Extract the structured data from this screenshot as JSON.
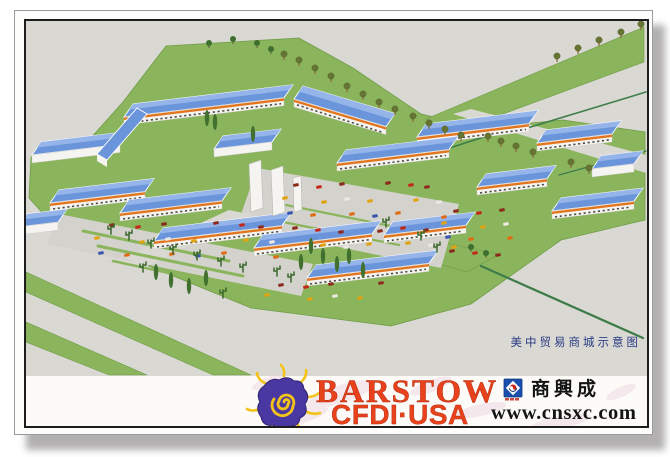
{
  "postcard": {
    "caption": "美中贸易商城示意图"
  },
  "footer": {
    "barstow_line1": "BARSTOW",
    "barstow_line2": "CFDI·USA",
    "sxc_name": "商興成",
    "sxc_url": "www.cnsxc.com"
  },
  "palette": {
    "logo_red": "#e8421c",
    "logo_purple": "#4a38a2",
    "logo_yellow": "#f4c318",
    "sxc_blue": "#1a4fae",
    "caption_blue": "#2a3d85"
  },
  "scene": {
    "colors": {
      "ground": "#dad8d3",
      "lot": "#d4d2cd",
      "lawn": "#8ab55c",
      "lawnDark": "#6f9c46",
      "roof": "#6b95da",
      "roofLight": "#94b4ea",
      "wall": "#f5f4f0",
      "awning": "#e2751d",
      "window": "#4e4e46",
      "roadline": "#3e7d49"
    },
    "site_lawn": [
      [
        30,
        155
      ],
      [
        88,
        138
      ],
      [
        122,
        100
      ],
      [
        165,
        44
      ],
      [
        298,
        36
      ],
      [
        352,
        66
      ],
      [
        420,
        112
      ],
      [
        478,
        126
      ],
      [
        562,
        118
      ],
      [
        644,
        130
      ],
      [
        644,
        218
      ],
      [
        560,
        238
      ],
      [
        470,
        302
      ],
      [
        390,
        324
      ],
      [
        250,
        306
      ],
      [
        148,
        264
      ],
      [
        55,
        226
      ],
      [
        28,
        196
      ]
    ],
    "patches": [
      {
        "pts": [
          [
            425,
            117
          ],
          [
            643,
            25
          ],
          [
            643,
            60
          ],
          [
            448,
            132
          ]
        ],
        "fill": "lawn"
      },
      {
        "pts": [
          [
            25,
            270
          ],
          [
            250,
            373
          ],
          [
            212,
            373
          ],
          [
            25,
            290
          ]
        ],
        "fill": "lawn"
      },
      {
        "pts": [
          [
            25,
            320
          ],
          [
            146,
            373
          ],
          [
            108,
            373
          ],
          [
            25,
            340
          ]
        ],
        "fill": "lawn"
      },
      {
        "pts": [
          [
            405,
            233
          ],
          [
            498,
            252
          ],
          [
            466,
            270
          ],
          [
            390,
            248
          ]
        ],
        "fill": "lawn"
      }
    ],
    "roads": [
      {
        "pts": [
          [
            452,
            112
          ],
          [
            470,
            107
          ],
          [
            645,
            153
          ],
          [
            645,
            171
          ]
        ],
        "fill": "ground"
      },
      {
        "pts": [
          [
            256,
            166
          ],
          [
            458,
            202
          ],
          [
            440,
            266
          ],
          [
            236,
            224
          ]
        ],
        "fill": "lot"
      },
      {
        "pts": [
          [
            58,
            212
          ],
          [
            312,
            262
          ],
          [
            300,
            294
          ],
          [
            46,
            242
          ]
        ],
        "fill": "lot"
      },
      {
        "pts": [
          [
            228,
            208
          ],
          [
            252,
            213
          ],
          [
            146,
            264
          ],
          [
            124,
            256
          ]
        ],
        "fill": "ground"
      }
    ],
    "lines": [
      [
        405,
        160,
        520,
        123,
        1.6,
        "roadline"
      ],
      [
        523,
        127,
        645,
        90,
        1.6,
        "roadline"
      ],
      [
        558,
        173,
        645,
        149,
        1.4,
        "roadline"
      ],
      [
        480,
        264,
        642,
        336,
        2.2,
        "roadline"
      ],
      [
        82,
        229,
        228,
        259,
        3,
        "lawn"
      ],
      [
        97,
        244,
        242,
        274,
        3,
        "lawn"
      ],
      [
        112,
        259,
        205,
        279,
        2.5,
        "lawn"
      ],
      [
        285,
        203,
        420,
        230,
        2.2,
        "lawn"
      ],
      [
        272,
        218,
        398,
        243,
        2.2,
        "lawn"
      ]
    ],
    "quads": [
      {
        "pts": [
          [
            96,
            152
          ],
          [
            136,
            106
          ],
          [
            146,
            112
          ],
          [
            106,
            158
          ]
        ]
      }
    ],
    "buildings": [
      {
        "x": 302,
        "y": 84,
        "len": 92,
        "dir": "b",
        "awn": 1
      },
      {
        "x": 132,
        "y": 102,
        "len": 160,
        "awn": 1
      },
      {
        "x": 545,
        "y": 128,
        "len": 75,
        "awn": 1
      },
      {
        "x": 425,
        "y": 122,
        "len": 112,
        "awn": 1
      },
      {
        "x": 40,
        "y": 140,
        "len": 88,
        "awn": 0
      },
      {
        "x": 222,
        "y": 134,
        "len": 58,
        "awn": 0
      },
      {
        "x": 345,
        "y": 148,
        "len": 112,
        "awn": 1
      },
      {
        "x": 600,
        "y": 154,
        "len": 42,
        "awn": 0
      },
      {
        "x": 485,
        "y": 172,
        "len": 70,
        "awn": 1
      },
      {
        "x": 58,
        "y": 188,
        "len": 95,
        "awn": 1
      },
      {
        "x": 128,
        "y": 198,
        "len": 102,
        "awn": 1
      },
      {
        "x": 392,
        "y": 220,
        "len": 82,
        "awn": 1
      },
      {
        "x": 560,
        "y": 196,
        "len": 82,
        "awn": 1
      },
      {
        "x": 162,
        "y": 226,
        "len": 128,
        "awn": 1
      },
      {
        "x": 262,
        "y": 233,
        "len": 118,
        "awn": 1
      },
      {
        "x": 26,
        "y": 212,
        "len": 40,
        "awn": 0
      },
      {
        "x": 315,
        "y": 263,
        "len": 122,
        "awn": 1
      }
    ],
    "pylons": [
      [
        [
          248,
          162
        ],
        [
          260,
          158
        ],
        [
          262,
          206
        ],
        [
          250,
          210
        ]
      ],
      [
        [
          270,
          168
        ],
        [
          282,
          164
        ],
        [
          284,
          210
        ],
        [
          272,
          214
        ]
      ],
      [
        [
          292,
          176
        ],
        [
          300,
          174
        ],
        [
          301,
          208
        ],
        [
          293,
          210
        ]
      ]
    ],
    "car_clusters": [
      {
        "x": 272,
        "y": 182,
        "cols": 8,
        "rows": 5,
        "dx": 22,
        "dy": 15,
        "shift": 6
      },
      {
        "x": 85,
        "y": 222,
        "cols": 8,
        "rows": 3,
        "dx": 25,
        "dy": 15,
        "shift": 5
      },
      {
        "x": 255,
        "y": 282,
        "cols": 6,
        "rows": 2,
        "dx": 24,
        "dy": 12,
        "shift": 5
      },
      {
        "x": 432,
        "y": 208,
        "cols": 4,
        "rows": 4,
        "dx": 22,
        "dy": 14,
        "shift": 5
      }
    ],
    "car_colors": [
      "#c5271b",
      "#df6b15",
      "#ece9e4",
      "#8c2a1d",
      "#3a55b0",
      "#e0a413"
    ],
    "trees": [
      {
        "x": 283,
        "y": 58,
        "t": "tan"
      },
      {
        "x": 298,
        "y": 64,
        "t": "tan"
      },
      {
        "x": 314,
        "y": 72,
        "t": "tan"
      },
      {
        "x": 330,
        "y": 80,
        "t": "tan"
      },
      {
        "x": 346,
        "y": 90,
        "t": "tan"
      },
      {
        "x": 362,
        "y": 98,
        "t": "tan"
      },
      {
        "x": 378,
        "y": 106,
        "t": "tan"
      },
      {
        "x": 394,
        "y": 113,
        "t": "tan"
      },
      {
        "x": 412,
        "y": 120,
        "t": "tan"
      },
      {
        "x": 428,
        "y": 127,
        "t": "tan"
      },
      {
        "x": 444,
        "y": 133,
        "t": "tan"
      },
      {
        "x": 460,
        "y": 139,
        "t": "tan"
      },
      {
        "x": 487,
        "y": 140,
        "t": "tan"
      },
      {
        "x": 500,
        "y": 145,
        "t": "tan"
      },
      {
        "x": 515,
        "y": 150,
        "t": "tan"
      },
      {
        "x": 532,
        "y": 156,
        "t": "tan"
      },
      {
        "x": 570,
        "y": 166,
        "t": "tan"
      },
      {
        "x": 588,
        "y": 172,
        "t": "tan"
      },
      {
        "x": 556,
        "y": 60,
        "t": "tan"
      },
      {
        "x": 577,
        "y": 52,
        "t": "tan"
      },
      {
        "x": 598,
        "y": 44,
        "t": "tan"
      },
      {
        "x": 620,
        "y": 36,
        "t": "tan"
      },
      {
        "x": 640,
        "y": 28,
        "t": "tan"
      },
      {
        "x": 208,
        "y": 46,
        "t": "green"
      },
      {
        "x": 232,
        "y": 42,
        "t": "green"
      },
      {
        "x": 256,
        "y": 46,
        "t": "green"
      },
      {
        "x": 270,
        "y": 52,
        "t": "green"
      },
      {
        "x": 206,
        "y": 124,
        "t": "poplar"
      },
      {
        "x": 214,
        "y": 128,
        "t": "poplar"
      },
      {
        "x": 252,
        "y": 140,
        "t": "poplar"
      },
      {
        "x": 310,
        "y": 252,
        "t": "poplar"
      },
      {
        "x": 322,
        "y": 262,
        "t": "poplar"
      },
      {
        "x": 336,
        "y": 270,
        "t": "poplar"
      },
      {
        "x": 348,
        "y": 262,
        "t": "poplar"
      },
      {
        "x": 300,
        "y": 268,
        "t": "poplar"
      },
      {
        "x": 362,
        "y": 276,
        "t": "poplar"
      },
      {
        "x": 290,
        "y": 280,
        "t": "cactus"
      },
      {
        "x": 276,
        "y": 274,
        "t": "cactus"
      },
      {
        "x": 385,
        "y": 225,
        "t": "cactus"
      },
      {
        "x": 420,
        "y": 238,
        "t": "cactus"
      },
      {
        "x": 436,
        "y": 250,
        "t": "cactus"
      },
      {
        "x": 128,
        "y": 238,
        "t": "cactus"
      },
      {
        "x": 150,
        "y": 246,
        "t": "cactus"
      },
      {
        "x": 172,
        "y": 252,
        "t": "cactus"
      },
      {
        "x": 196,
        "y": 258,
        "t": "cactus"
      },
      {
        "x": 110,
        "y": 232,
        "t": "cactus"
      },
      {
        "x": 220,
        "y": 264,
        "t": "cactus"
      },
      {
        "x": 242,
        "y": 270,
        "t": "cactus"
      },
      {
        "x": 155,
        "y": 278,
        "t": "poplar"
      },
      {
        "x": 170,
        "y": 286,
        "t": "poplar"
      },
      {
        "x": 188,
        "y": 292,
        "t": "poplar"
      },
      {
        "x": 205,
        "y": 284,
        "t": "poplar"
      },
      {
        "x": 142,
        "y": 270,
        "t": "cactus"
      },
      {
        "x": 222,
        "y": 296,
        "t": "cactus"
      },
      {
        "x": 470,
        "y": 250,
        "t": "green"
      },
      {
        "x": 485,
        "y": 256,
        "t": "green"
      }
    ]
  }
}
